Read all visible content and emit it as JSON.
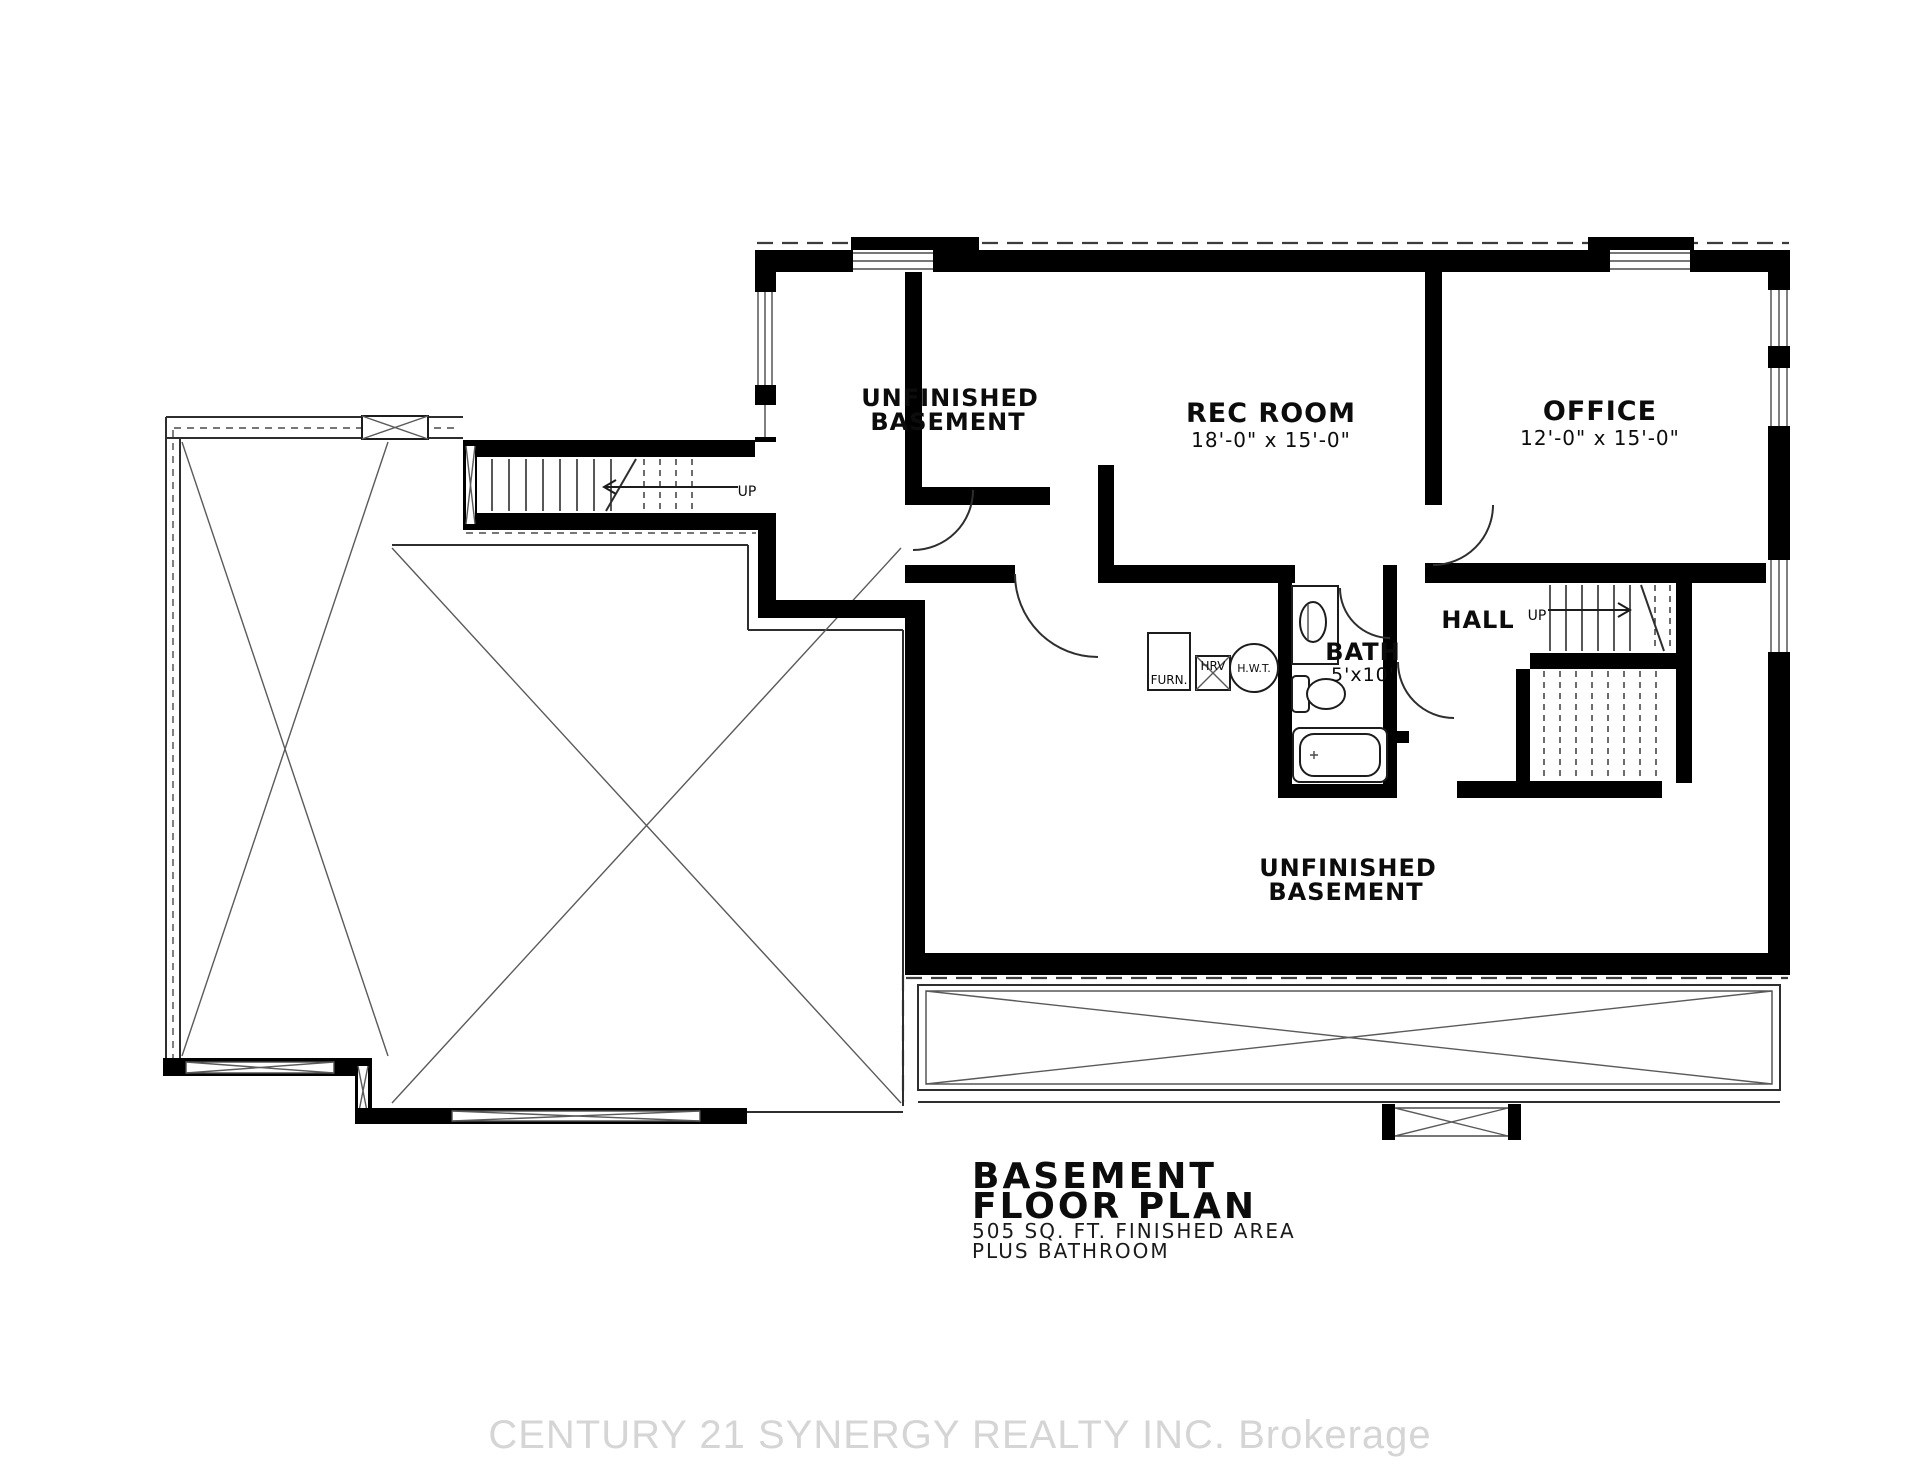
{
  "document": {
    "kind": "basement floor plan drawing",
    "background": "#ffffff"
  },
  "title_block": {
    "line1": "BASEMENT",
    "line2": "FLOOR PLAN",
    "line3": "505 SQ. FT. FINISHED AREA",
    "line4": "PLUS BATHROOM"
  },
  "watermark": {
    "text": "CENTURY 21 SYNERGY REALTY INC. Brokerage",
    "color": "#d5d5d5"
  },
  "rooms": {
    "unfinished_upper": {
      "line1": "UNFINISHED",
      "line2": "BASEMENT"
    },
    "rec_room": {
      "name": "REC ROOM",
      "dims": "18'-0\" x 15'-0\""
    },
    "office": {
      "name": "OFFICE",
      "dims": "12'-0\" x 15'-0\""
    },
    "hall": {
      "name": "HALL"
    },
    "bath": {
      "name": "BATH",
      "dims": "5'x10'"
    },
    "unfinished_lower": {
      "line1": "UNFINISHED",
      "line2": "BASEMENT"
    }
  },
  "equipment": {
    "furnace": "FURN.",
    "hrv": "HRV",
    "hot_water_tank": "H.W.T."
  },
  "stairs": {
    "stair_left_label": "UP",
    "stair_hall_label": "UP"
  },
  "colors": {
    "walls": "#000000",
    "thin_lines": "#2e2e2e",
    "watermark": "#d5d5d5"
  }
}
